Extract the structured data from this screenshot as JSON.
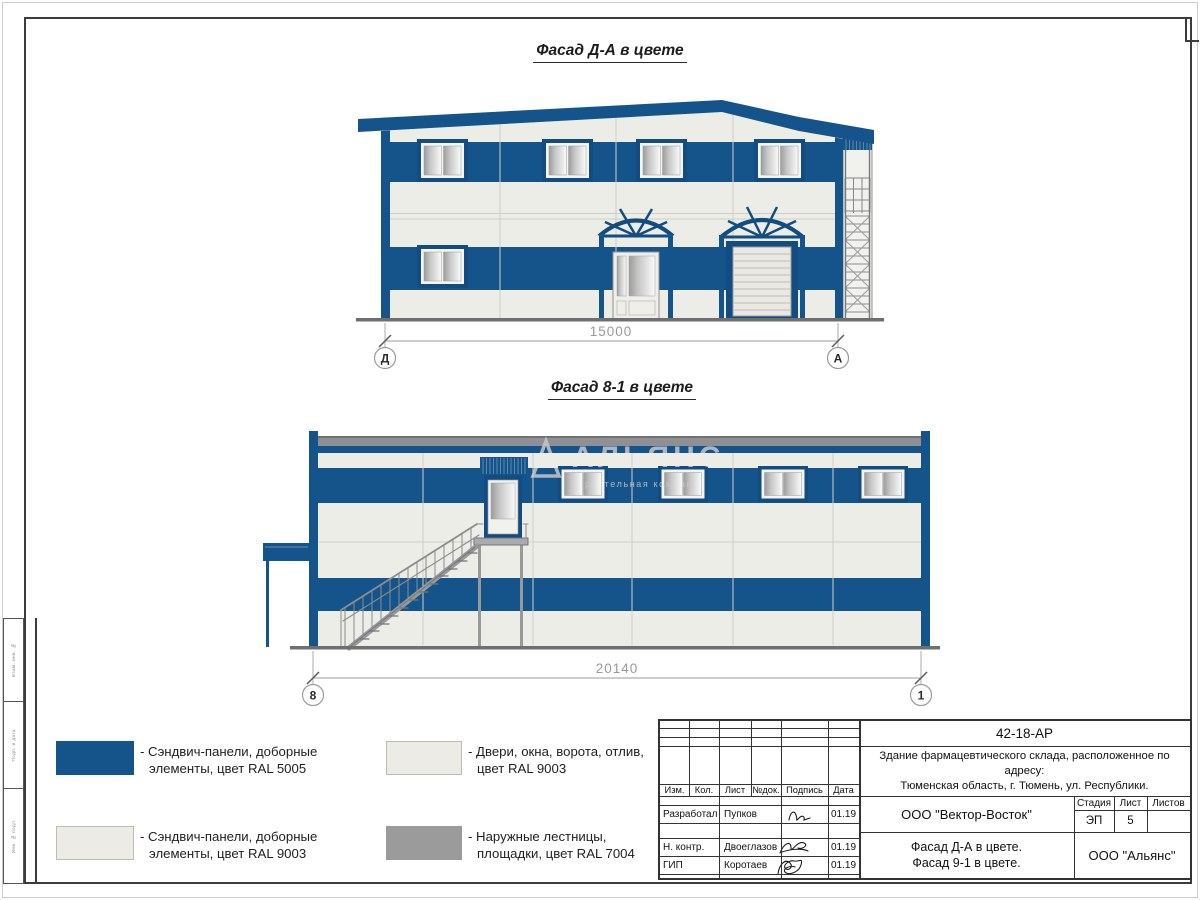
{
  "drawing1": {
    "title": "Фасад Д-А в цвете",
    "dimension": "15000",
    "axis_left": "Д",
    "axis_right": "А"
  },
  "drawing2": {
    "title": "Фасад 8-1 в цвете",
    "dimension": "20140",
    "axis_left": "8",
    "axis_right": "1"
  },
  "watermark": {
    "name": "АЛЬЯНС",
    "subtitle": "строительная компания"
  },
  "legend": {
    "items": [
      {
        "line1": "- Сэндвич-панели, доборные",
        "line2": "элементы, цвет RAL 5005",
        "swatch": "#15548A",
        "border": "#15548A"
      },
      {
        "line1": "- Двери, окна, ворота, отлив,",
        "line2": "цвет RAL 9003",
        "swatch": "#ECEBE5",
        "border": "#BDBDB5"
      },
      {
        "line1": "- Сэндвич-панели, доборные",
        "line2": "элементы, цвет RAL 9003",
        "swatch": "#ECEBE5",
        "border": "#BDBDB5"
      },
      {
        "line1": "- Наружные лестницы,",
        "line2": "площадки, цвет RAL 7004",
        "swatch": "#9B9B9B",
        "border": "#9B9B9B"
      }
    ]
  },
  "stamp": {
    "doc_number": "42-18-АР",
    "project_line1": "Здание фармацевтического склада, расположенное по адресу:",
    "project_line2": "Тюменская область, г. Тюмень, ул. Республики.",
    "columns": [
      "Изм.",
      "Кол.",
      "Лист",
      "№док.",
      "Подпись",
      "Дата"
    ],
    "rows": [
      {
        "role": "Разработал",
        "name": "Пупков",
        "date": "01.19"
      },
      {
        "role": "Н. контр.",
        "name": "Двоеглазов",
        "date": "01.19"
      },
      {
        "role": "ГИП",
        "name": "Коротаев",
        "date": "01.19"
      }
    ],
    "company": "ООО \"Вектор-Восток\"",
    "stage_label": "Стадия",
    "sheet_label": "Лист",
    "sheets_label": "Листов",
    "stage": "ЭП",
    "sheet": "5",
    "sheets": "",
    "sheet_title_line1": "Фасад Д-А в цвете.",
    "sheet_title_line2": "Фасад 9-1 в цвете.",
    "org": "ООО \"Альянс\""
  },
  "side_column": {
    "labels": [
      "Взам. инв. №",
      "Подп. и дата",
      "Инв. № подл."
    ]
  },
  "colors": {
    "blue_ral5005": "#15548A",
    "panel_ral9003": "#EDEDE7",
    "stair_ral7004": "#97999B",
    "roof_gray": "#8E9093"
  }
}
